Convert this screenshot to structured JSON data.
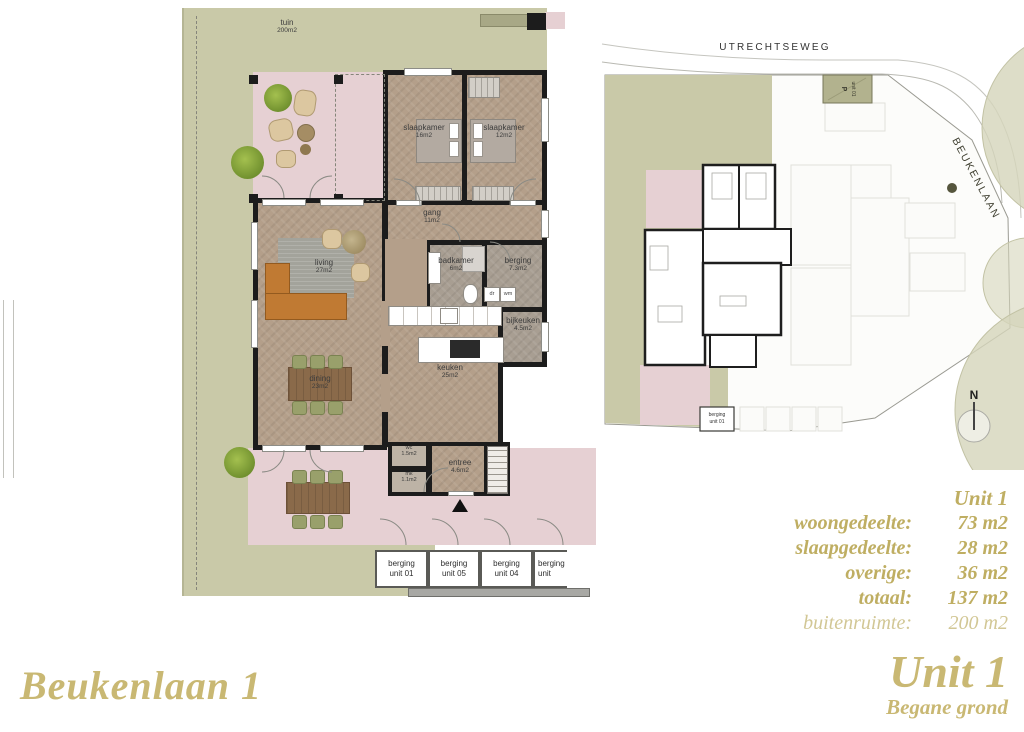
{
  "floorplan": {
    "garden": {
      "name": "tuin",
      "area": "200m2"
    },
    "rooms": [
      {
        "name": "slaapkamer",
        "area": "16m2"
      },
      {
        "name": "slaapkamer",
        "area": "12m2"
      },
      {
        "name": "gang",
        "area": "11m2"
      },
      {
        "name": "living",
        "area": "27m2"
      },
      {
        "name": "badkamer",
        "area": "6m2"
      },
      {
        "name": "berging",
        "area": "7.3m2"
      },
      {
        "name": "bijkeuken",
        "area": "4.5m2"
      },
      {
        "name": "keuken",
        "area": "25m2"
      },
      {
        "name": "dining",
        "area": "23m2"
      },
      {
        "name": "wc",
        "area": "1.5m2"
      },
      {
        "name": "mk",
        "area": "1.1m2"
      },
      {
        "name": "entree",
        "area": "4.6m2"
      }
    ],
    "appliances": [
      {
        "label": "dr"
      },
      {
        "label": "wm"
      }
    ],
    "storage_units": [
      {
        "line1": "berging",
        "line2": "unit 01"
      },
      {
        "line1": "berging",
        "line2": "unit 05"
      },
      {
        "line1": "berging",
        "line2": "unit 04"
      },
      {
        "line1": "berging",
        "line2": "unit"
      }
    ]
  },
  "siteplan": {
    "road_top": "UTRECHTSEWEG",
    "road_right": "BEUKENLAAN",
    "north": "N",
    "parking": {
      "line1": "P",
      "line2": "unit 01"
    },
    "storage": {
      "line1": "berging",
      "line2": "unit 01"
    }
  },
  "stats": {
    "header": "Unit 1",
    "rows": [
      {
        "label": "woongedeelte:",
        "value": "73 m2"
      },
      {
        "label": "slaapgedeelte:",
        "value": "28 m2"
      },
      {
        "label": "overige:",
        "value": "36 m2"
      },
      {
        "label": "totaal:",
        "value": "137 m2"
      },
      {
        "label": "buitenruimte:",
        "value": "200 m2"
      }
    ]
  },
  "footer": {
    "left_title": "Beukenlaan 1",
    "right_title": "Unit 1",
    "right_subtitle": "Begane grond"
  },
  "colors": {
    "accent_gold": "#c4b46b",
    "garden_green": "#c9c9a8",
    "terrace_pink": "#e6d0d3",
    "floor_wood": "#b49f8a",
    "wall_black": "#1c1c1c"
  }
}
